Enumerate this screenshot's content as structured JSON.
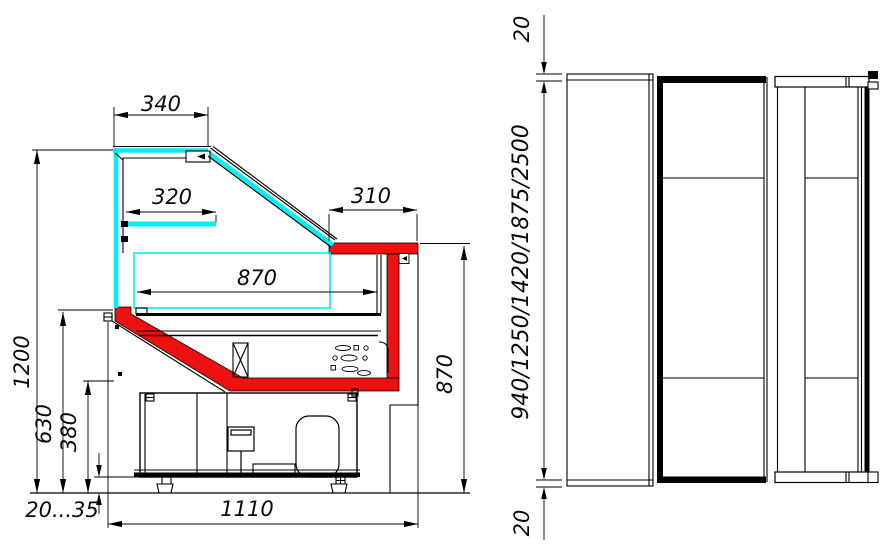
{
  "drawing": {
    "kind": "refrigerated-display-case-technical-drawing",
    "background": "#ffffff",
    "colors": {
      "glass": "#00eef2",
      "body_accent": "#ee1111",
      "line": "#000000"
    },
    "side_view": {
      "label": "side-section-view",
      "dimensions": {
        "canopy_top": "340",
        "glass_shelf": "320",
        "worktop": "310",
        "display_deck": "870",
        "overall_height": "1200",
        "front_glass_bottom": "630",
        "front_panel_bottom": "380",
        "foot_adjust_range": "20...35",
        "overall_depth": "1110",
        "worktop_height": "870"
      }
    },
    "plan_view": {
      "label": "top-plan-view",
      "dimensions": {
        "end_overhang_top": "20",
        "overall_lengths": "940/1250/1420/1875/2500",
        "end_overhang_bottom": "20"
      }
    }
  }
}
